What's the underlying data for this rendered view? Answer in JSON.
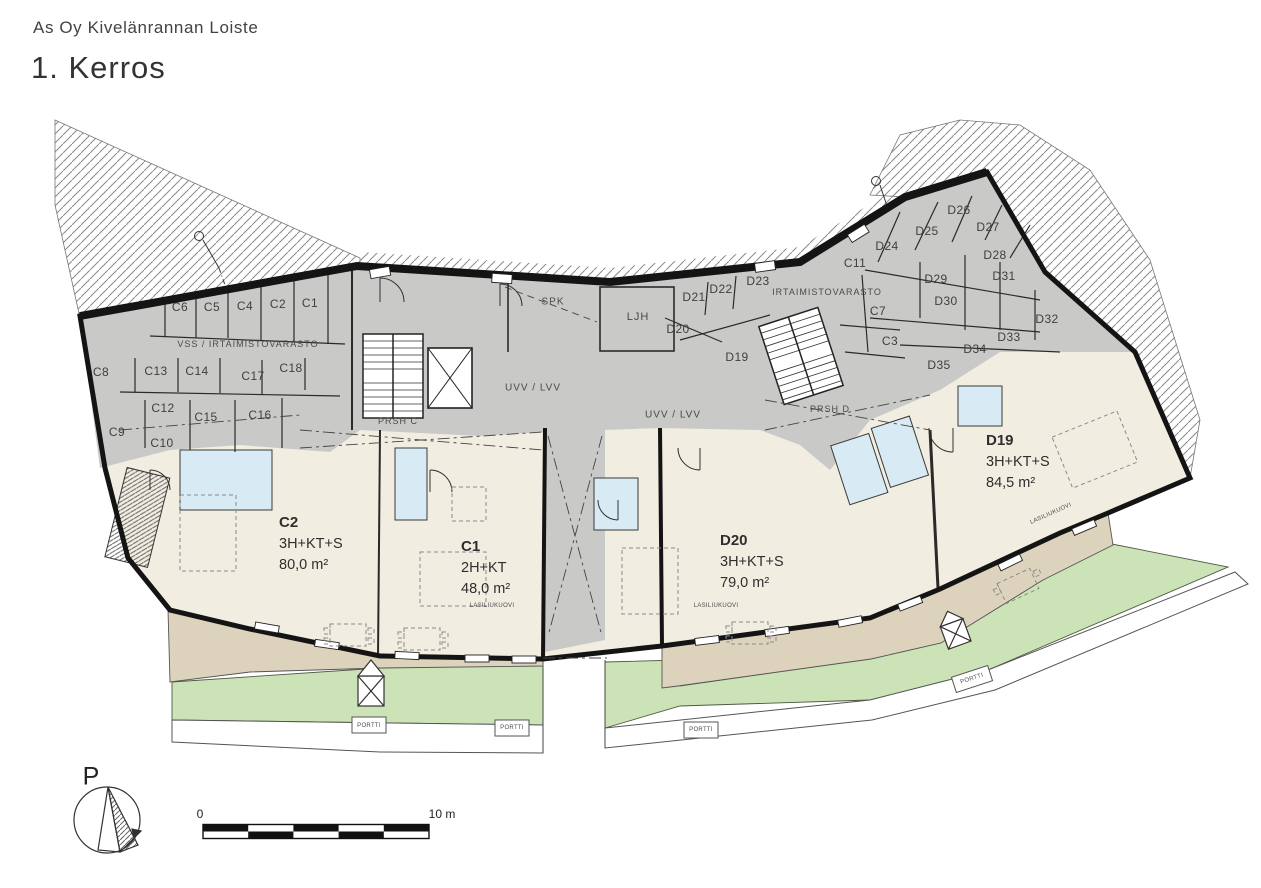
{
  "header": {
    "project_title": "As Oy Kivelänrannan Loiste",
    "floor_title": "1. Kerros"
  },
  "colors": {
    "storage_gray": "#c9c9c8",
    "apartment_cream": "#f1ede0",
    "terrace_tan": "#ddd3bd",
    "lawn_green": "#cbe3b6",
    "bathroom_blue": "#d8eaf4",
    "wall_black": "#141414",
    "hatch_gray": "#8a8a8a"
  },
  "apartments": [
    {
      "id": "C2",
      "layout": "3H+KT+S",
      "area": "80,0 m²",
      "x": 279,
      "y": 512
    },
    {
      "id": "C1",
      "layout": "2H+KT",
      "area": "48,0 m²",
      "x": 461,
      "y": 536
    },
    {
      "id": "D20",
      "layout": "3H+KT+S",
      "area": "79,0 m²",
      "x": 720,
      "y": 530
    },
    {
      "id": "D19",
      "layout": "3H+KT+S",
      "area": "84,5 m²",
      "x": 986,
      "y": 430
    }
  ],
  "storage_labels": [
    {
      "text": "C6",
      "x": 180,
      "y": 307
    },
    {
      "text": "C5",
      "x": 212,
      "y": 307
    },
    {
      "text": "C4",
      "x": 245,
      "y": 306
    },
    {
      "text": "C2",
      "x": 278,
      "y": 304
    },
    {
      "text": "C1",
      "x": 310,
      "y": 303
    },
    {
      "text": "C8",
      "x": 101,
      "y": 372
    },
    {
      "text": "C13",
      "x": 156,
      "y": 371
    },
    {
      "text": "C14",
      "x": 197,
      "y": 371
    },
    {
      "text": "C17",
      "x": 253,
      "y": 376
    },
    {
      "text": "C18",
      "x": 291,
      "y": 368
    },
    {
      "text": "C12",
      "x": 163,
      "y": 408
    },
    {
      "text": "C15",
      "x": 206,
      "y": 417
    },
    {
      "text": "C16",
      "x": 260,
      "y": 415
    },
    {
      "text": "C9",
      "x": 117,
      "y": 432
    },
    {
      "text": "C10",
      "x": 162,
      "y": 443
    },
    {
      "text": "D21",
      "x": 694,
      "y": 297
    },
    {
      "text": "D22",
      "x": 721,
      "y": 289
    },
    {
      "text": "D23",
      "x": 758,
      "y": 281
    },
    {
      "text": "D20",
      "x": 678,
      "y": 329
    },
    {
      "text": "D19",
      "x": 737,
      "y": 357
    },
    {
      "text": "C11",
      "x": 855,
      "y": 263
    },
    {
      "text": "D24",
      "x": 887,
      "y": 246
    },
    {
      "text": "D25",
      "x": 927,
      "y": 231
    },
    {
      "text": "D26",
      "x": 959,
      "y": 210
    },
    {
      "text": "D27",
      "x": 988,
      "y": 227
    },
    {
      "text": "D28",
      "x": 995,
      "y": 255
    },
    {
      "text": "D29",
      "x": 936,
      "y": 279
    },
    {
      "text": "D30",
      "x": 946,
      "y": 301
    },
    {
      "text": "D31",
      "x": 1004,
      "y": 276
    },
    {
      "text": "D32",
      "x": 1047,
      "y": 319
    },
    {
      "text": "D33",
      "x": 1009,
      "y": 337
    },
    {
      "text": "D34",
      "x": 975,
      "y": 349
    },
    {
      "text": "D35",
      "x": 939,
      "y": 365
    },
    {
      "text": "C7",
      "x": 878,
      "y": 311
    },
    {
      "text": "C3",
      "x": 890,
      "y": 341
    }
  ],
  "tech_labels": [
    {
      "text": "VSS / IRTAIMISTOVARASTO",
      "x": 248,
      "y": 344,
      "fs": 9
    },
    {
      "text": "IRTAIMISTOVARASTO",
      "x": 827,
      "y": 292,
      "fs": 9
    },
    {
      "text": "SPK",
      "x": 553,
      "y": 302,
      "fs": 10
    },
    {
      "text": "LJH",
      "x": 638,
      "y": 317,
      "fs": 11
    },
    {
      "text": "UVV / LVV",
      "x": 533,
      "y": 388,
      "fs": 10
    },
    {
      "text": "UVV / LVV",
      "x": 673,
      "y": 415,
      "fs": 10
    },
    {
      "text": "PRSH C",
      "x": 398,
      "y": 421,
      "fs": 9
    },
    {
      "text": "PRSH D",
      "x": 830,
      "y": 409,
      "fs": 9
    }
  ],
  "small_labels": [
    {
      "text": "LASILIUKUOVI",
      "x": 492,
      "y": 606,
      "rot": 0
    },
    {
      "text": "LASILIUKUOVI",
      "x": 716,
      "y": 606,
      "rot": 0
    },
    {
      "text": "LASILIUKUOVI",
      "x": 1051,
      "y": 514,
      "rot": -24
    },
    {
      "text": "PORTTI",
      "x": 369,
      "y": 726,
      "rot": 0
    },
    {
      "text": "PORTTI",
      "x": 512,
      "y": 728,
      "rot": 0
    },
    {
      "text": "PORTTI",
      "x": 701,
      "y": 730,
      "rot": 0
    },
    {
      "text": "PORTTI",
      "x": 972,
      "y": 679,
      "rot": -18
    }
  ],
  "compass": {
    "label": "P"
  },
  "scale_bar": {
    "start_label": "0",
    "end_label": "10 m"
  }
}
